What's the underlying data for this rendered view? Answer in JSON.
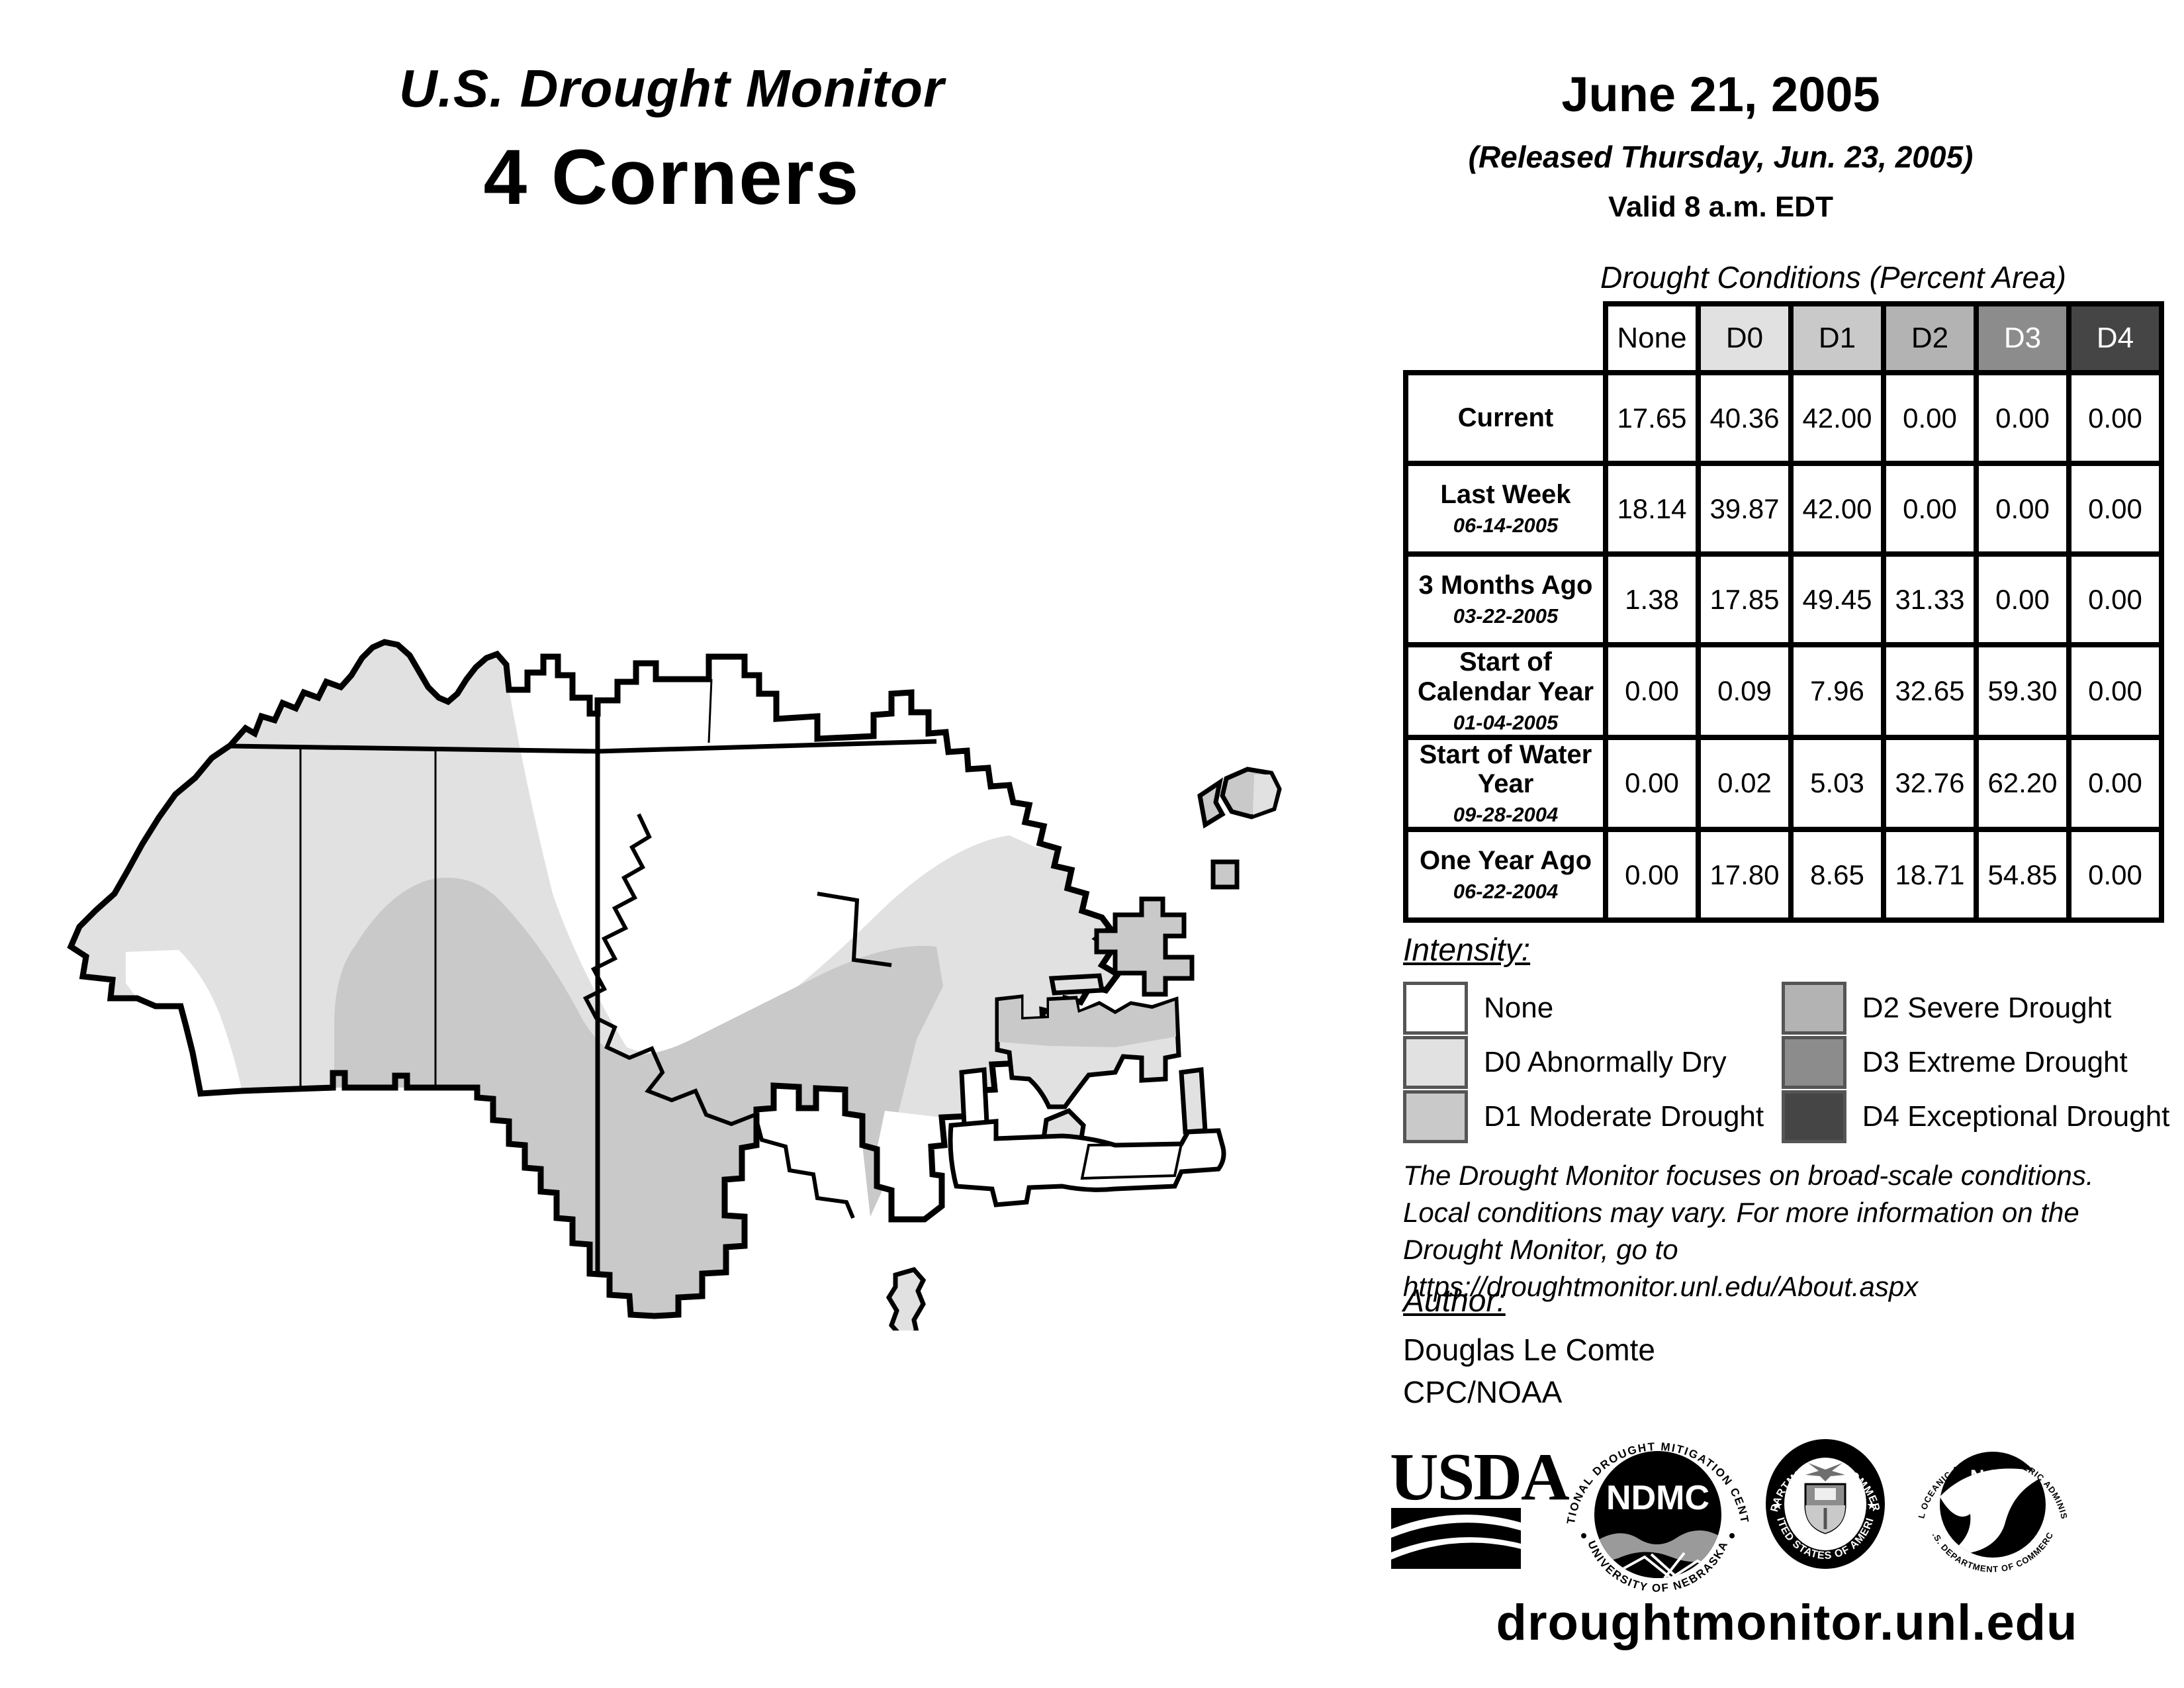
{
  "header": {
    "title": "U.S. Drought Monitor",
    "region": "4 Corners",
    "date": "June 21, 2005",
    "released": "(Released Thursday, Jun. 23, 2005)",
    "valid": "Valid 8 a.m. EDT"
  },
  "table": {
    "title": "Drought Conditions (Percent Area)",
    "columns": [
      "None",
      "D0",
      "D1",
      "D2",
      "D3",
      "D4"
    ],
    "rows": [
      {
        "label": "Current",
        "date": "",
        "values": [
          "17.65",
          "40.36",
          "42.00",
          "0.00",
          "0.00",
          "0.00"
        ]
      },
      {
        "label": "Last Week",
        "date": "06-14-2005",
        "values": [
          "18.14",
          "39.87",
          "42.00",
          "0.00",
          "0.00",
          "0.00"
        ]
      },
      {
        "label": "3 Months Ago",
        "date": "03-22-2005",
        "values": [
          "1.38",
          "17.85",
          "49.45",
          "31.33",
          "0.00",
          "0.00"
        ]
      },
      {
        "label": "Start of Calendar Year",
        "date": "01-04-2005",
        "values": [
          "0.00",
          "0.09",
          "7.96",
          "32.65",
          "59.30",
          "0.00"
        ]
      },
      {
        "label": "Start of Water Year",
        "date": "09-28-2004",
        "values": [
          "0.00",
          "0.02",
          "5.03",
          "32.76",
          "62.20",
          "0.00"
        ]
      },
      {
        "label": "One Year Ago",
        "date": "06-22-2004",
        "values": [
          "0.00",
          "17.80",
          "8.65",
          "18.71",
          "54.85",
          "0.00"
        ]
      }
    ]
  },
  "legend": {
    "title": "Intensity:",
    "items": [
      {
        "code": "None",
        "label": "None",
        "color": "#FFFFFF"
      },
      {
        "code": "D0",
        "label": "D0 Abnormally Dry",
        "color": "#E1E1E1"
      },
      {
        "code": "D1",
        "label": "D1 Moderate Drought",
        "color": "#C9C9C9"
      },
      {
        "code": "D2",
        "label": "D2 Severe Drought",
        "color": "#B3B3B3"
      },
      {
        "code": "D3",
        "label": "D3 Extreme Drought",
        "color": "#8C8C8C"
      },
      {
        "code": "D4",
        "label": "D4 Exceptional Drought",
        "color": "#454545"
      }
    ]
  },
  "disclaimer": {
    "line1": "The Drought Monitor focuses on broad-scale conditions.",
    "line2": "Local conditions may vary. For more information on the",
    "line3": "Drought Monitor, go to https://droughtmonitor.unl.edu/About.aspx"
  },
  "author": {
    "title": "Author:",
    "name": "Douglas Le Comte",
    "org": "CPC/NOAA"
  },
  "logos": {
    "usda": "USDA",
    "ndmc": "NDMC",
    "ndmc_top": "NATIONAL DROUGHT MITIGATION CENTER",
    "ndmc_bottom": "UNIVERSITY OF NEBRASKA",
    "doc_top": "DEPARTMENT OF COMMERCE",
    "doc_bottom": "UNITED STATES OF AMERICA",
    "noaa": "NOAA",
    "noaa_top": "NATIONAL OCEANIC AND ATMOSPHERIC ADMINISTRATION",
    "noaa_bottom": "U.S. DEPARTMENT OF COMMERCE"
  },
  "footer": {
    "url": "droughtmonitor.unl.edu"
  }
}
